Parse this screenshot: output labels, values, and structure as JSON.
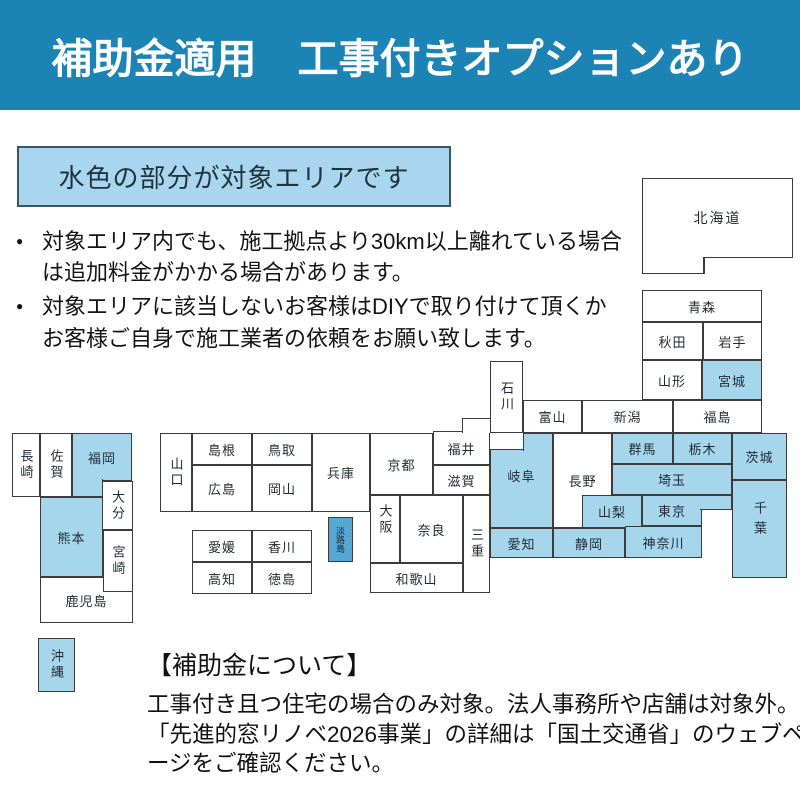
{
  "banner": {
    "title": "補助金適用　工事付きオプションあり",
    "bg_color": "#1b84b5"
  },
  "area_note": {
    "label": "水色の部分が対象エリアです",
    "bg_color": "#a9d6ee",
    "border_color": "#3a5563"
  },
  "bullets": [
    "対象エリア内でも、施工拠点より30km以上離れている場合は追加料金がかかる場合があります。",
    "対象エリアに該当しないお客様はDIYで取り付けて頂くかお客様ご自身で施工業者の依頼をお願い致します。"
  ],
  "map": {
    "covered_color": "#a5d6ec",
    "not_covered_color": "#ffffff",
    "awaji_color": "#57a7d3",
    "line_color": "#3c3c3c",
    "prefectures": [
      {
        "label": "北海道",
        "covered": false
      },
      {
        "label": "青森",
        "covered": false
      },
      {
        "label": "秋田",
        "covered": false
      },
      {
        "label": "岩手",
        "covered": false
      },
      {
        "label": "山形",
        "covered": false
      },
      {
        "label": "宮城",
        "covered": true
      },
      {
        "label": "新潟",
        "covered": false
      },
      {
        "label": "福島",
        "covered": false
      },
      {
        "label": "石川",
        "covered": false
      },
      {
        "label": "富山",
        "covered": false
      },
      {
        "label": "福井",
        "covered": false
      },
      {
        "label": "長野",
        "covered": false
      },
      {
        "label": "岐阜",
        "covered": true
      },
      {
        "label": "群馬",
        "covered": true
      },
      {
        "label": "栃木",
        "covered": true
      },
      {
        "label": "茨城",
        "covered": true
      },
      {
        "label": "埼玉",
        "covered": true
      },
      {
        "label": "山梨",
        "covered": true
      },
      {
        "label": "東京",
        "covered": true
      },
      {
        "label": "千葉",
        "covered": true
      },
      {
        "label": "神奈川",
        "covered": true
      },
      {
        "label": "静岡",
        "covered": true
      },
      {
        "label": "愛知",
        "covered": true
      },
      {
        "label": "滋賀",
        "covered": false
      },
      {
        "label": "京都",
        "covered": false
      },
      {
        "label": "兵庫",
        "covered": false
      },
      {
        "label": "大阪",
        "covered": false
      },
      {
        "label": "奈良",
        "covered": false
      },
      {
        "label": "三重",
        "covered": false
      },
      {
        "label": "和歌山",
        "covered": false
      },
      {
        "label": "淡路島",
        "covered": true
      },
      {
        "label": "山口",
        "covered": false
      },
      {
        "label": "島根",
        "covered": false
      },
      {
        "label": "鳥取",
        "covered": false
      },
      {
        "label": "広島",
        "covered": false
      },
      {
        "label": "岡山",
        "covered": false
      },
      {
        "label": "愛媛",
        "covered": false
      },
      {
        "label": "香川",
        "covered": false
      },
      {
        "label": "高知",
        "covered": false
      },
      {
        "label": "徳島",
        "covered": false
      },
      {
        "label": "長崎",
        "covered": false
      },
      {
        "label": "佐賀",
        "covered": false
      },
      {
        "label": "福岡",
        "covered": true
      },
      {
        "label": "大分",
        "covered": false
      },
      {
        "label": "熊本",
        "covered": true
      },
      {
        "label": "宮崎",
        "covered": false
      },
      {
        "label": "鹿児島",
        "covered": false
      },
      {
        "label": "沖縄",
        "covered": true
      }
    ]
  },
  "subsidy_note": {
    "title": "【補助金について】",
    "body": "工事付き且つ住宅の場合のみ対象。法人事務所や店舗は対象外。「先進的窓リノベ2026事業」の詳細は「国土交通省」のウェブページをご確認ください。"
  }
}
